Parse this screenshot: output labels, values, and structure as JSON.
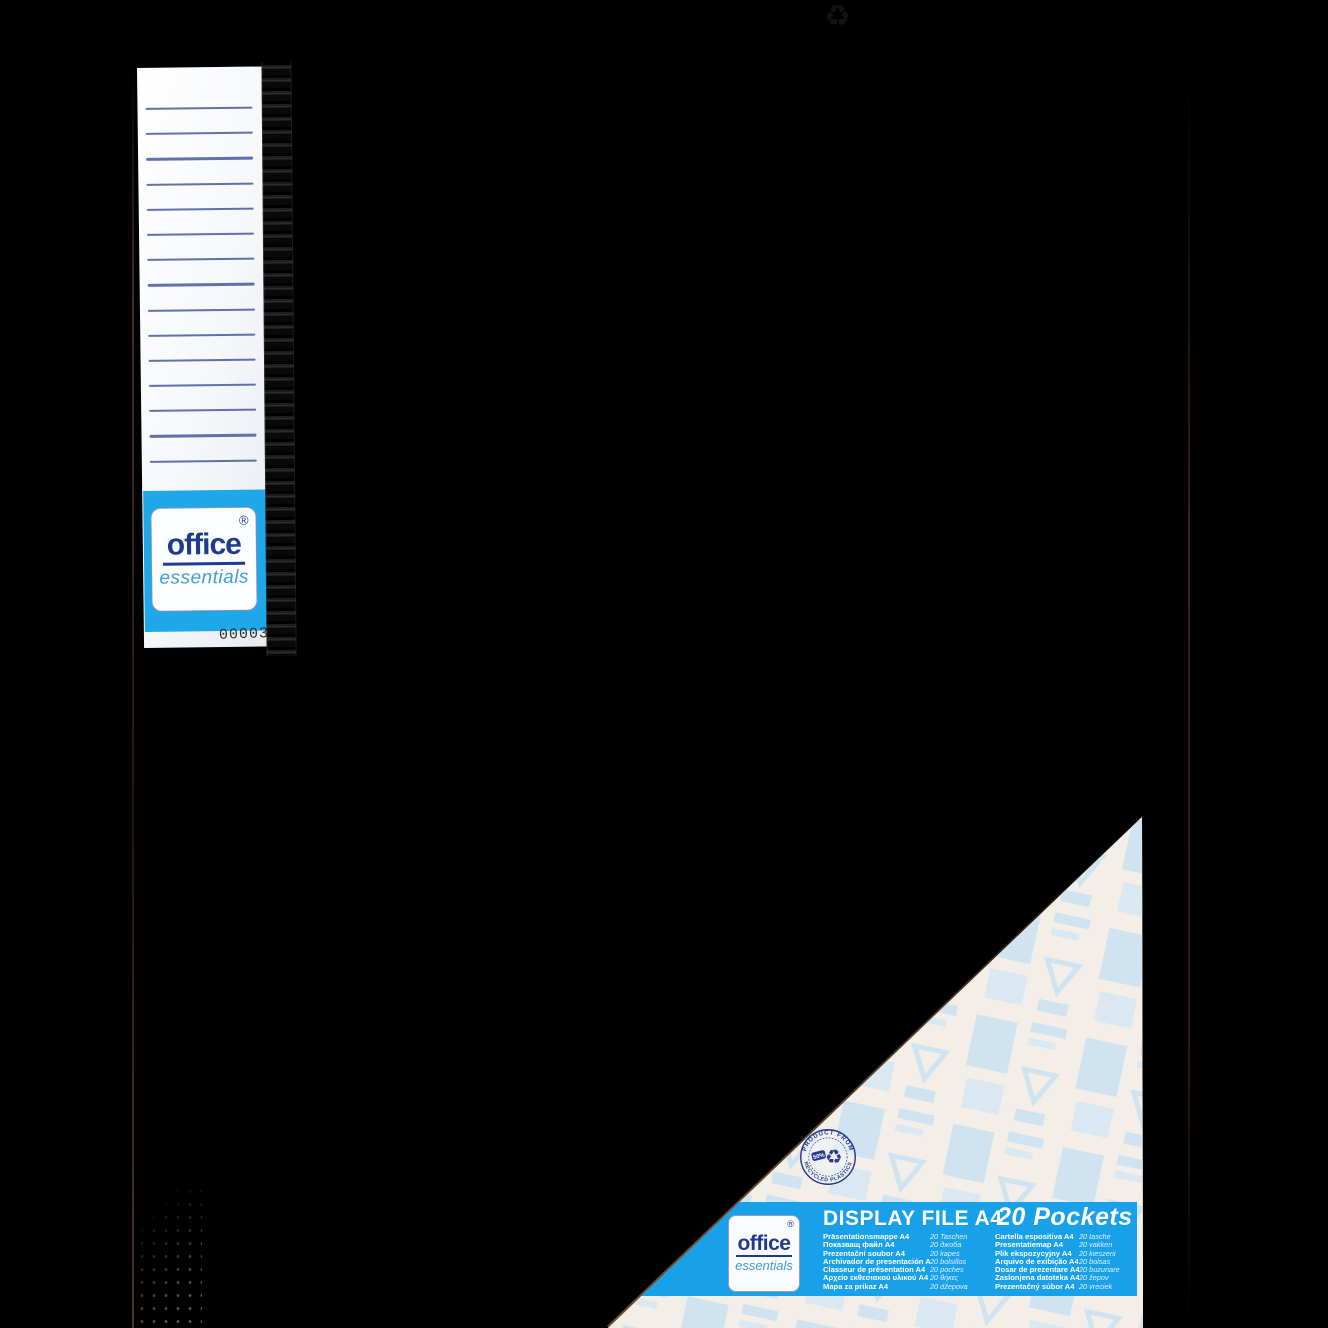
{
  "product": {
    "embossed_code": "00003",
    "top_emboss_icon": "♻"
  },
  "brand": {
    "name_line1": "office",
    "name_line2": "essentials",
    "registered": "®"
  },
  "recycled_badge": {
    "arc_top": "PRODUCT FROM",
    "arc_bottom": "RECYCLED PLASTICS",
    "percent": "50%",
    "icon": "♻"
  },
  "banner": {
    "title": "DISPLAY FILE A4",
    "pockets_label": "20 Pockets",
    "translations_left": [
      {
        "label": "Präsentationsmappe A4",
        "value": "20 Taschen"
      },
      {
        "label": "Показващ файл А4",
        "value": "20 джоба"
      },
      {
        "label": "Prezentační soubor A4",
        "value": "20 kapes"
      },
      {
        "label": "Archivador de presentación A4",
        "value": "20 bolsillos"
      },
      {
        "label": "Classeur de présentation A4",
        "value": "20 poches"
      },
      {
        "label": "Αρχείο εκθεσιακού υλικού A4",
        "value": "20 θήκες"
      },
      {
        "label": "Mapa za prikaz A4",
        "value": "20 džepova"
      }
    ],
    "translations_right": [
      {
        "label": "Cartella espositiva A4",
        "value": "20 tasche"
      },
      {
        "label": "Presentatiemap A4",
        "value": "20 vakken"
      },
      {
        "label": "Plik ekspozycyjny A4",
        "value": "20 kieszeni"
      },
      {
        "label": "Arquivo de exibição A4",
        "value": "20 bolsas"
      },
      {
        "label": "Dosar de prezentare A4",
        "value": "20 buzunare"
      },
      {
        "label": "Zaslonjena datoteka A4",
        "value": "20 žepov"
      },
      {
        "label": "Prezentačný súbor A4",
        "value": "20 vreciek"
      }
    ]
  },
  "colors": {
    "background": "#000000",
    "banner_blue": "#18A0E8",
    "label_box_blue": "#1EA7E9",
    "brand_navy": "#1E3B8E",
    "brand_light_blue": "#3F9DD8",
    "paper_offwhite": "#F3EFE8",
    "pattern_blue": "#C9E2F1",
    "ruled_line_blue": "#46589A"
  }
}
